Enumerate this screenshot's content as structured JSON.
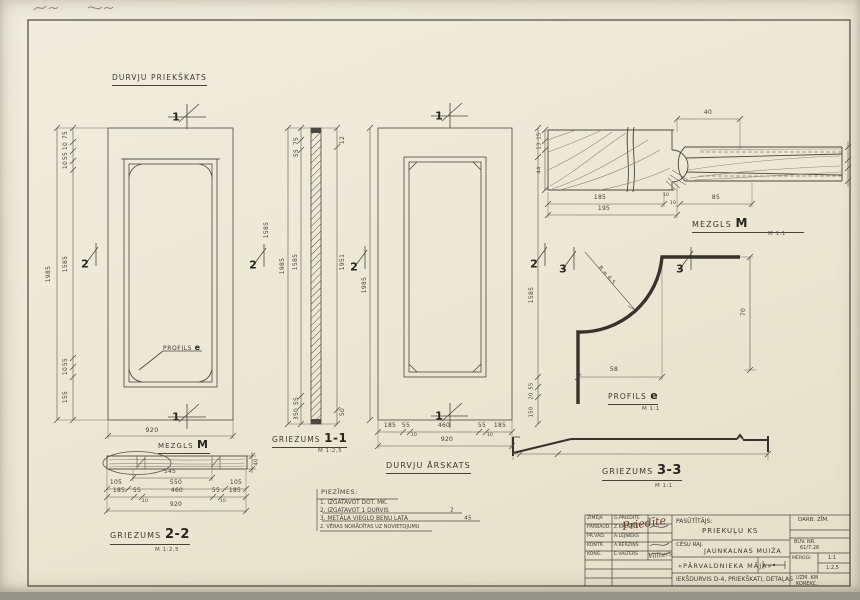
{
  "titles": {
    "front_view": "DURVJU PRIEKŠKATS",
    "outside_view": "DURVJU ĀRSKATS",
    "s11_prefix": "GRIEZUMS",
    "s11_num": "1-1",
    "s11_scale": "M 1:2,5",
    "s22_prefix": "GRIEZUMS",
    "s22_num": "2-2",
    "s22_scale": "M 1:2,5",
    "s33_prefix": "GRIEZUMS",
    "s33_num": "3-3",
    "s33_scale": "M 1:1",
    "mezgls_prefix": "MEZGLS",
    "mezgls_num": "M",
    "mezgls_scale": "M 1:1",
    "mezgls2_prefix": "MEZGLS",
    "mezgls2_num": "M",
    "profils_prefix": "PROFILS",
    "profils_num": "e",
    "profils_scale": "M 1:1",
    "profils_ref_prefix": "PROFILS",
    "profils_ref_num": "e"
  },
  "notes": {
    "heading": "PIEZĪMES:",
    "items": [
      {
        "text": "1. IZGATAVOT DOT. MK.",
        "struck": false
      },
      {
        "text": "2. IZGATAVOT 1 DURVIS",
        "struck": true
      },
      {
        "text": "3. METĀLA VIEGLO BEŅU LATA",
        "struck": true
      },
      {
        "text": "2. VĒRAS NORĀDĪTAS UZ NOVIETOJUMU",
        "struck": false
      }
    ]
  },
  "section_markers": [
    {
      "n": "1",
      "x": 176,
      "y": 117
    },
    {
      "n": "1",
      "x": 176,
      "y": 417
    },
    {
      "n": "1",
      "x": 439,
      "y": 116
    },
    {
      "n": "1",
      "x": 439,
      "y": 416
    },
    {
      "n": "2",
      "x": 85,
      "y": 264
    },
    {
      "n": "2",
      "x": 253,
      "y": 265
    },
    {
      "n": "2",
      "x": 354,
      "y": 267
    },
    {
      "n": "2",
      "x": 534,
      "y": 264
    },
    {
      "n": "3",
      "x": 563,
      "y": 269
    },
    {
      "n": "3",
      "x": 680,
      "y": 269
    }
  ],
  "dim_labels": [
    {
      "t": "75",
      "x": 66,
      "y": 135,
      "r": -90
    },
    {
      "t": "10",
      "x": 66,
      "y": 146,
      "r": -90
    },
    {
      "t": "55",
      "x": 66,
      "y": 156,
      "r": -90
    },
    {
      "t": "10",
      "x": 66,
      "y": 165,
      "r": -90
    },
    {
      "t": "1585",
      "x": 66,
      "y": 264,
      "r": -90
    },
    {
      "t": "55",
      "x": 66,
      "y": 362,
      "r": -90
    },
    {
      "t": "10",
      "x": 66,
      "y": 371,
      "r": -90
    },
    {
      "t": "155",
      "x": 66,
      "y": 397,
      "r": -90
    },
    {
      "t": "1985",
      "x": 49,
      "y": 274,
      "r": -90
    },
    {
      "t": "1585",
      "x": 267,
      "y": 230,
      "r": -90
    },
    {
      "t": "920",
      "x": 152,
      "y": 430,
      "s": 6.5
    },
    {
      "t": "40",
      "x": 257,
      "y": 462,
      "r": -90,
      "s": 5
    },
    {
      "t": "545",
      "x": 170,
      "y": 472
    },
    {
      "t": "105",
      "x": 116,
      "y": 483
    },
    {
      "t": "550",
      "x": 176,
      "y": 483
    },
    {
      "t": "105",
      "x": 236,
      "y": 483
    },
    {
      "t": "185",
      "x": 119,
      "y": 491
    },
    {
      "t": "55",
      "x": 137,
      "y": 491
    },
    {
      "t": "460",
      "x": 177,
      "y": 491
    },
    {
      "t": "55",
      "x": 216,
      "y": 491
    },
    {
      "t": "185",
      "x": 235,
      "y": 491
    },
    {
      "t": "10",
      "x": 145,
      "y": 502,
      "s": 4.5
    },
    {
      "t": "10",
      "x": 223,
      "y": 502,
      "s": 4.5
    },
    {
      "t": "920",
      "x": 176,
      "y": 505
    },
    {
      "t": "75",
      "x": 297,
      "y": 141,
      "r": -90
    },
    {
      "t": "55",
      "x": 297,
      "y": 153,
      "r": -90
    },
    {
      "t": "1585",
      "x": 296,
      "y": 262,
      "r": -90
    },
    {
      "t": "1985",
      "x": 283,
      "y": 266,
      "r": -90
    },
    {
      "t": "55",
      "x": 297,
      "y": 401,
      "r": -90
    },
    {
      "t": "350",
      "x": 297,
      "y": 414,
      "r": -90
    },
    {
      "t": "12",
      "x": 343,
      "y": 140,
      "r": -90
    },
    {
      "t": "1951",
      "x": 343,
      "y": 262,
      "r": -90
    },
    {
      "t": "50",
      "x": 343,
      "y": 412,
      "r": -90
    },
    {
      "t": "185",
      "x": 390,
      "y": 426
    },
    {
      "t": "55",
      "x": 406,
      "y": 426
    },
    {
      "t": "460",
      "x": 444,
      "y": 426
    },
    {
      "t": "55",
      "x": 482,
      "y": 426
    },
    {
      "t": "185",
      "x": 500,
      "y": 426
    },
    {
      "t": "10",
      "x": 414,
      "y": 436,
      "s": 4.5
    },
    {
      "t": "10",
      "x": 490,
      "y": 436,
      "s": 4.5
    },
    {
      "t": "920",
      "x": 447,
      "y": 440
    },
    {
      "t": "1985",
      "x": 365,
      "y": 285,
      "r": -90
    },
    {
      "t": "40",
      "x": 708,
      "y": 113
    },
    {
      "t": "15",
      "x": 540,
      "y": 136,
      "r": -90,
      "s": 5
    },
    {
      "t": "13",
      "x": 540,
      "y": 146,
      "r": -90,
      "s": 5
    },
    {
      "t": "44",
      "x": 540,
      "y": 170,
      "r": -90,
      "s": 5
    },
    {
      "t": "185",
      "x": 600,
      "y": 198
    },
    {
      "t": "195",
      "x": 604,
      "y": 209
    },
    {
      "t": "85",
      "x": 716,
      "y": 198
    },
    {
      "t": "10",
      "x": 666,
      "y": 196,
      "s": 4.5
    },
    {
      "t": "10",
      "x": 673,
      "y": 204,
      "s": 4.5
    },
    {
      "t": "R = 6,5",
      "x": 606,
      "y": 276,
      "r": 49,
      "s": 5.5
    },
    {
      "t": "70",
      "x": 744,
      "y": 312,
      "r": -90
    },
    {
      "t": "58",
      "x": 614,
      "y": 370
    },
    {
      "t": "1585",
      "x": 532,
      "y": 295,
      "r": -90
    },
    {
      "t": "55",
      "x": 532,
      "y": 386,
      "r": -90,
      "s": 5
    },
    {
      "t": "20",
      "x": 532,
      "y": 396,
      "r": -90,
      "s": 5
    },
    {
      "t": "150",
      "x": 532,
      "y": 412,
      "r": -90,
      "s": 5
    },
    {
      "t": "2",
      "x": 452,
      "y": 511,
      "s": 5.5
    },
    {
      "t": "45",
      "x": 468,
      "y": 519,
      "s": 5.5
    }
  ],
  "titleblock": {
    "left_rows": [
      {
        "role": "ZĪMĒJA",
        "name": "G.PRIEDĪTE"
      },
      {
        "role": "PĀRBAUD.",
        "name": "Z.KALNIŅŠ"
      },
      {
        "role": "PR.VAD.",
        "name": "A.LEJNIEKS"
      },
      {
        "role": "KONTR.",
        "name": "A.BĒRZIŅŠ"
      },
      {
        "role": "KONS.",
        "name": "E.VALTERS"
      }
    ],
    "signature": "Priedīte",
    "signature2": "Valters",
    "client_label": "PASŪTĪTĀJS:",
    "client": "PRIEKUĻU KS",
    "district": "CĒSU RAJ.",
    "object": "JAUNKALNAS MUIŽA",
    "building": "«PĀRVALDNIEKA MĀJA»",
    "sheet_title": "IEKŠDURVIS D-4, PRIEKŠKATI, DETAĻAS",
    "drawing_type": "DARB. ZĪM.",
    "buildno_label": "BŪV. NR.",
    "buildno": "61/7.26",
    "scales_label": "MĒROGI",
    "scale1": "1:1",
    "scale2": "1:2,5",
    "footer1": "UZM. KM",
    "footer2": "KOREKC."
  }
}
